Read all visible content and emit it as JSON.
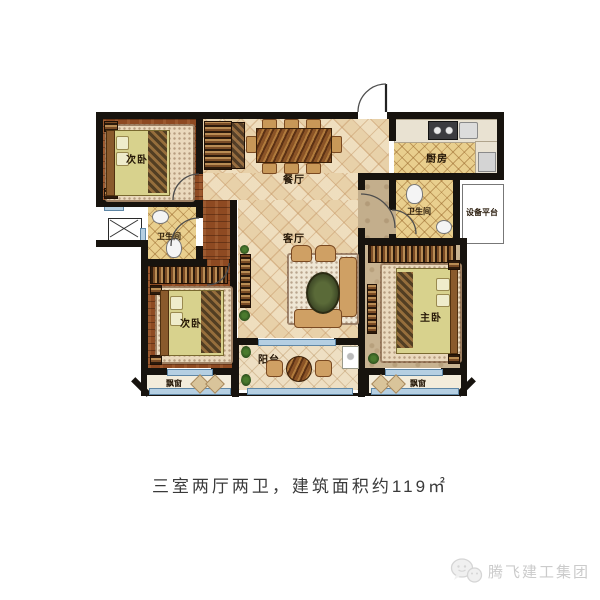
{
  "caption": {
    "text": "三室两厅两卫，建筑面积约119㎡"
  },
  "watermark": {
    "brand": "腾飞建工集团"
  },
  "rooms": {
    "bedroom_top_left": {
      "label": "次卧"
    },
    "bedroom_bottom_left": {
      "label": "次卧"
    },
    "master_bedroom": {
      "label": "主卧"
    },
    "dining": {
      "label": "餐厅"
    },
    "living": {
      "label": "客厅"
    },
    "kitchen": {
      "label": "厨房"
    },
    "bath_left": {
      "label": "卫生间"
    },
    "bath_right": {
      "label": "卫生间"
    },
    "equipment_platform": {
      "label": "设备平台"
    },
    "balcony": {
      "label": "阳台"
    },
    "bay_window_left": {
      "label": "飘窗"
    },
    "bay_window_right": {
      "label": "飘窗"
    }
  },
  "colors": {
    "wall": "#17130e",
    "tile_floor": "#ecd9b4",
    "wood_floor": "#8e4a22",
    "kitchen_tile": "#e9cf8e",
    "master_floor": "#c8b391",
    "window_glass": "#b5cfe2",
    "caption_text": "#3a3a3a",
    "watermark_text": "#cbcbcb"
  }
}
